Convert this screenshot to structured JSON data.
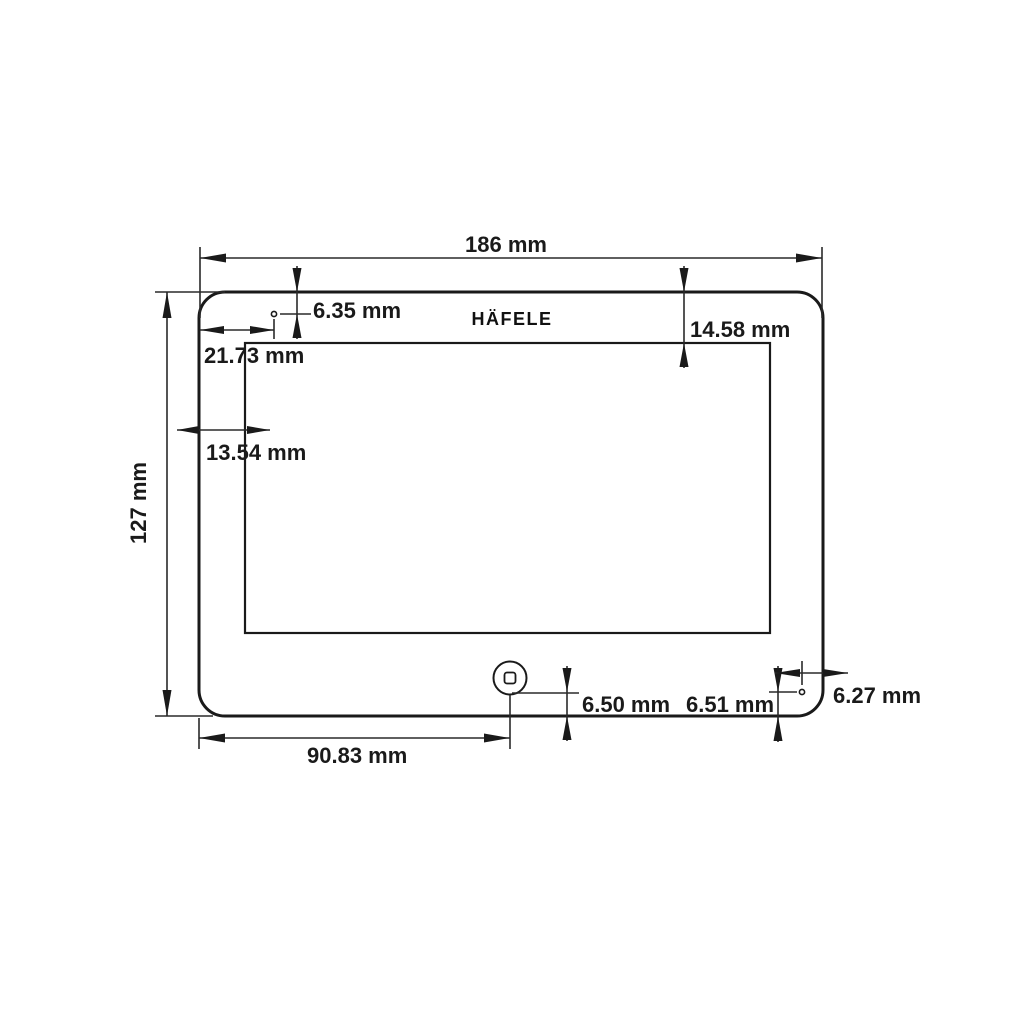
{
  "drawing": {
    "title": "tablet-panel-dimension-drawing",
    "brand": "HÄFELE",
    "colors": {
      "line": "#1a1a1a",
      "background": "#ffffff"
    },
    "units": "mm",
    "labels": {
      "overall_width": "186 mm",
      "overall_height": "127 mm",
      "hole_offset_top": "6.35 mm",
      "hole_offset_left": "21.73 mm",
      "screen_margin_left": "13.54 mm",
      "screen_margin_top": "14.58 mm",
      "home_button_from_left": "90.83 mm",
      "home_button_from_bottom": "6.50 mm",
      "mic_hole_from_bottom": "6.51 mm",
      "mic_hole_from_right": "6.27 mm"
    }
  }
}
